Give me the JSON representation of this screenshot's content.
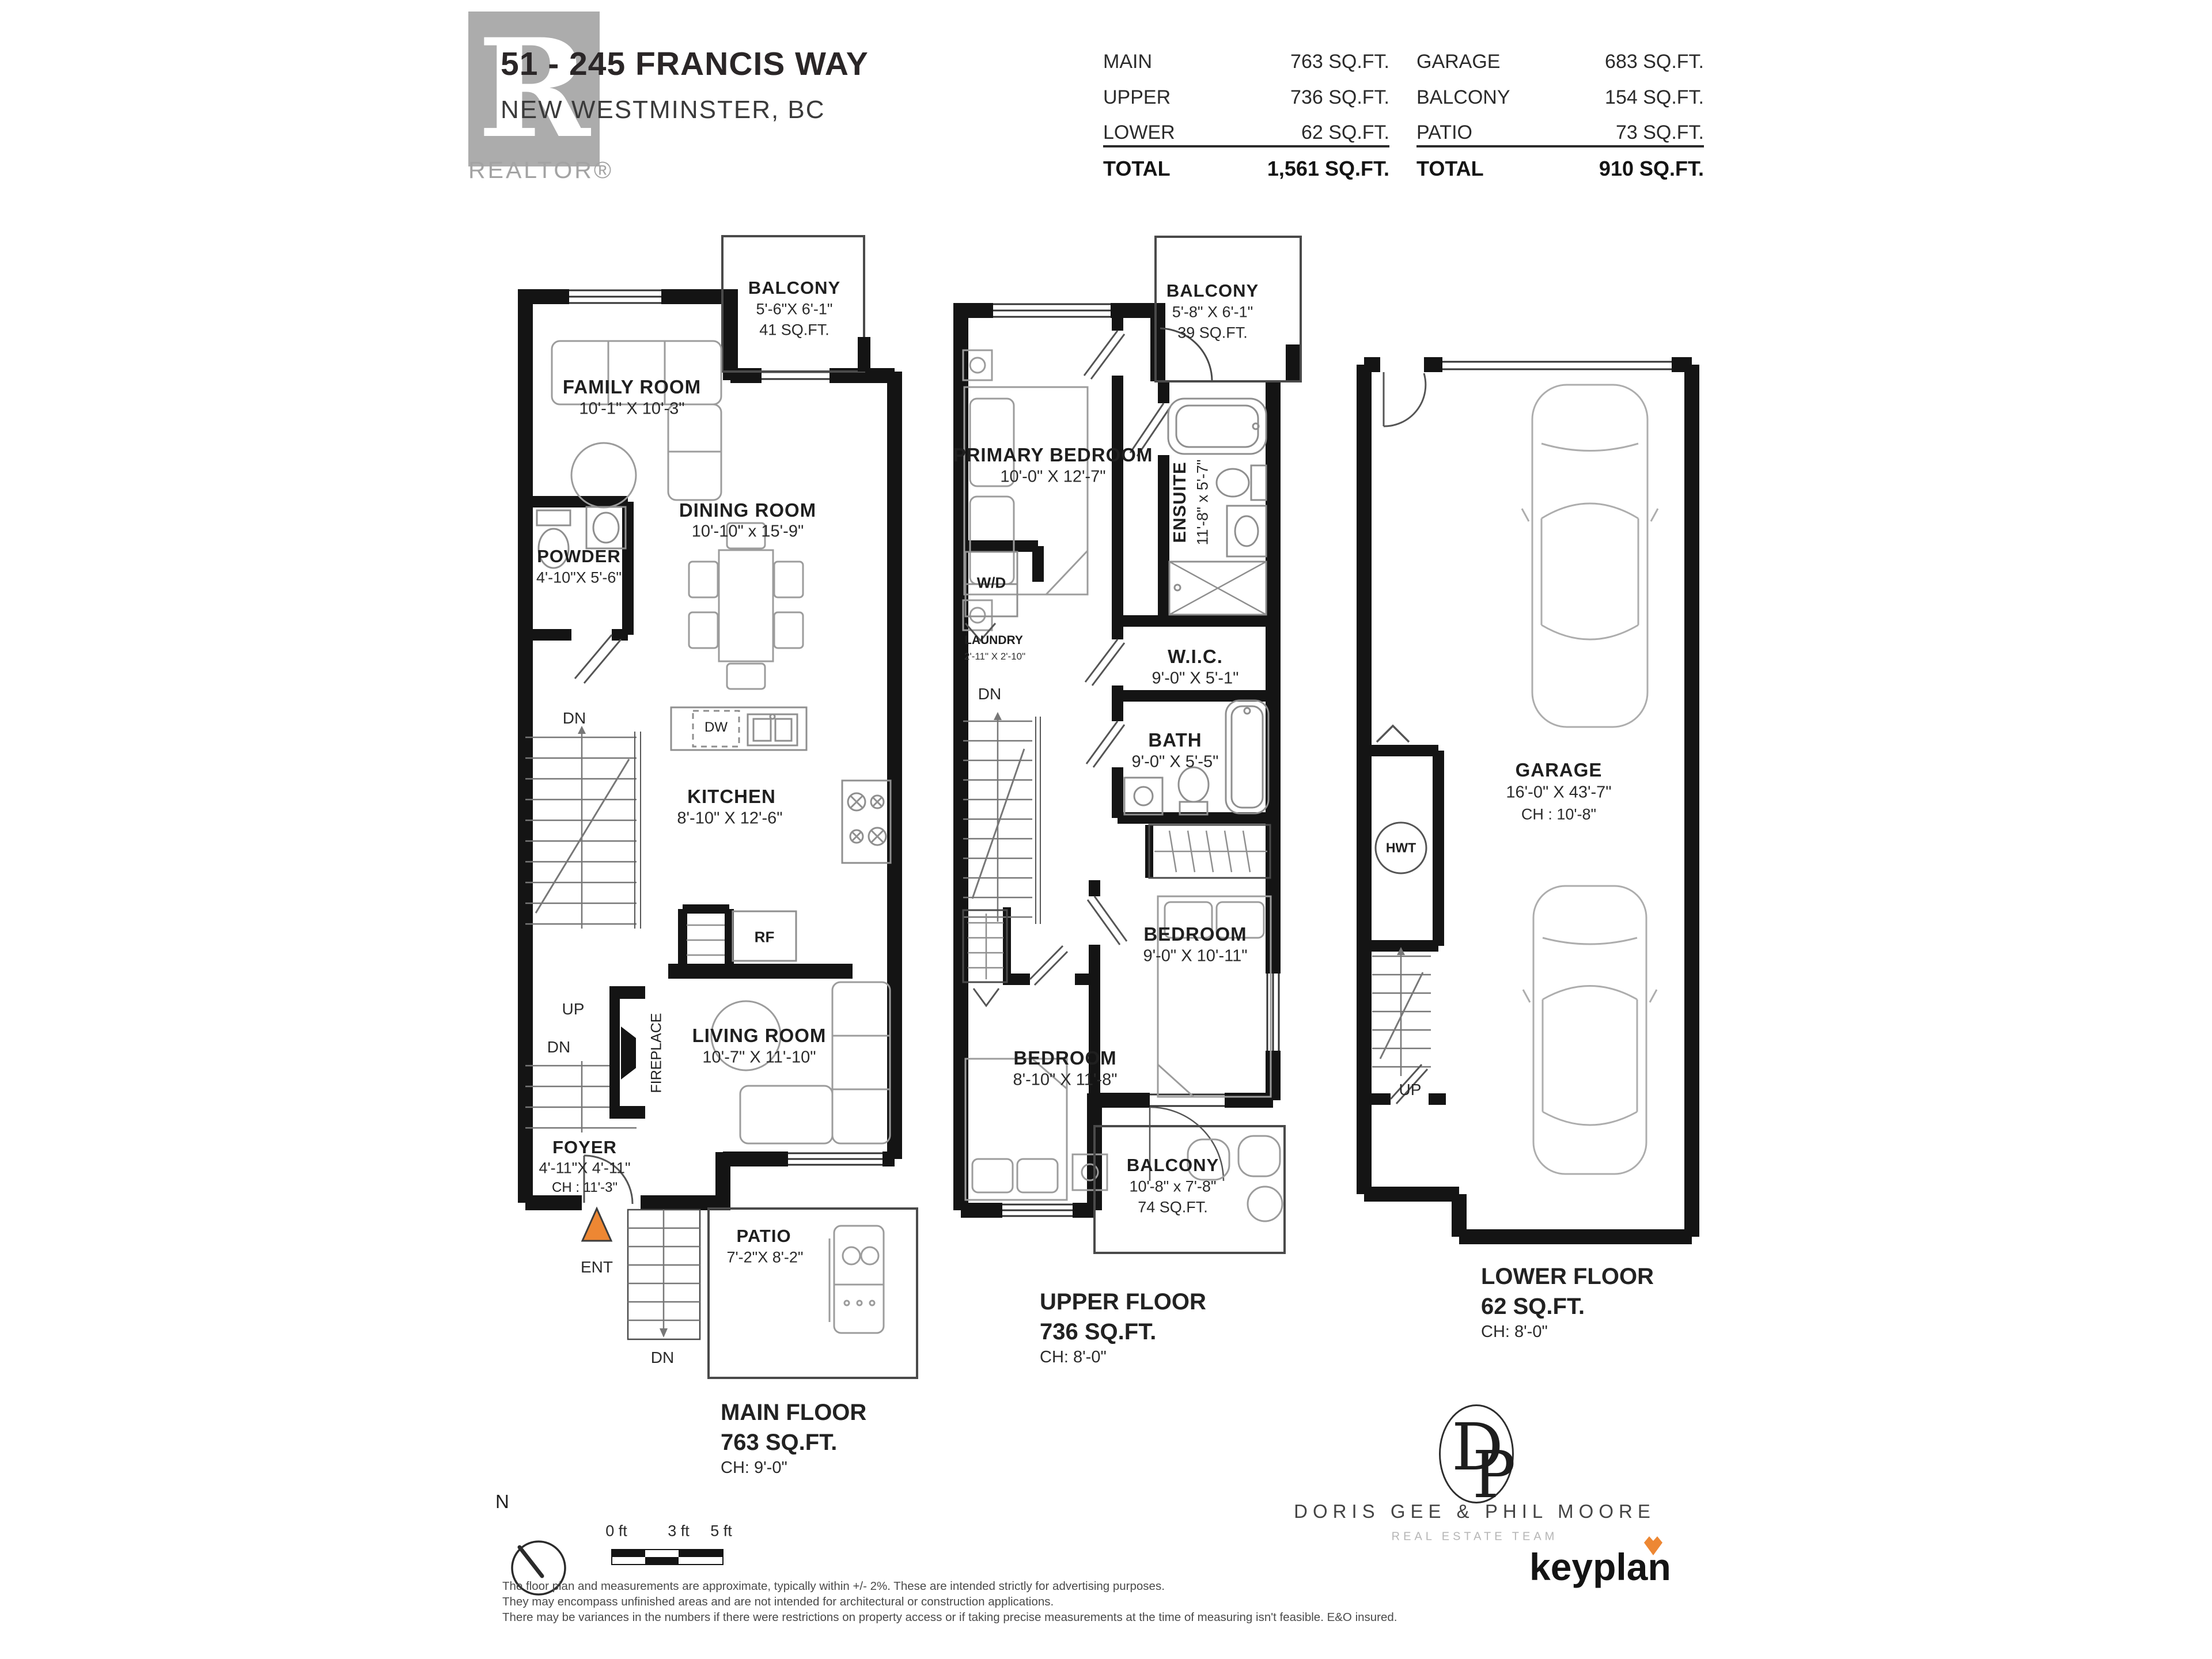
{
  "header": {
    "logo": {
      "letter": "R",
      "label": "REALTOR®"
    },
    "address_line1": "51 - 245 FRANCIS WAY",
    "address_line2": "NEW WESTMINSTER, BC",
    "area_table": {
      "left": {
        "rows": [
          {
            "label": "MAIN",
            "value": "763 SQ.FT."
          },
          {
            "label": "UPPER",
            "value": "736 SQ.FT."
          },
          {
            "label": "LOWER",
            "value": "62 SQ.FT."
          }
        ],
        "total": {
          "label": "TOTAL",
          "value": "1,561 SQ.FT."
        }
      },
      "right": {
        "rows": [
          {
            "label": "GARAGE",
            "value": "683 SQ.FT."
          },
          {
            "label": "BALCONY",
            "value": "154 SQ.FT."
          },
          {
            "label": "PATIO",
            "value": "73 SQ.FT."
          }
        ],
        "total": {
          "label": "TOTAL",
          "value": "910 SQ.FT."
        }
      }
    }
  },
  "main_floor": {
    "balcony": {
      "name": "BALCONY",
      "dim": "5'-6\"X 6'-1\"",
      "area": "41 SQ.FT."
    },
    "family_room": {
      "name": "FAMILY ROOM",
      "dim": "10'-1\"  X  10'-3\""
    },
    "dining_room": {
      "name": "DINING ROOM",
      "dim": "10'-10\"  x  15'-9\""
    },
    "powder": {
      "name": "POWDER",
      "dim": "4'-10\"X 5'-6\""
    },
    "kitchen": {
      "name": "KITCHEN",
      "dim": "8'-10\"  X  12'-6\""
    },
    "living_room": {
      "name": "LIVING ROOM",
      "dim": "10'-7\"  X  11'-10\""
    },
    "foyer": {
      "name": "FOYER",
      "dim": "4'-11\"X 4'-11\"",
      "ch": "CH : 11'-3\""
    },
    "patio": {
      "name": "PATIO",
      "dim": "7'-2\"X 8'-2\""
    },
    "markers": {
      "dn": "DN",
      "up": "UP",
      "dw": "DW",
      "rf": "RF",
      "ent": "ENT",
      "fireplace": "FIREPLACE"
    },
    "floor_label": {
      "line1": "MAIN FLOOR",
      "line2": "763 SQ.FT.",
      "line3": "CH: 9'-0\""
    }
  },
  "upper_floor": {
    "balcony_top": {
      "name": "BALCONY",
      "dim": "5'-8\" X 6'-1\"",
      "area": "39 SQ.FT."
    },
    "primary_bedroom": {
      "name": "PRIMARY BEDROOM",
      "dim": "10'-0\"  X  12'-7\""
    },
    "ensuite": {
      "name": "ENSUITE",
      "dim": "11'-8\" x 5'-7\""
    },
    "laundry": {
      "name": "LAUNDRY",
      "dim": "2'-11\" X 2'-10\""
    },
    "wic": {
      "name": "W.I.C.",
      "dim": "9'-0\"  X  5'-1\""
    },
    "bath": {
      "name": "BATH",
      "dim": "9'-0\" X 5'-5\""
    },
    "bedroom_right": {
      "name": "BEDROOM",
      "dim": "9'-0\"  X  10'-11\""
    },
    "bedroom_left": {
      "name": "BEDROOM",
      "dim": "8'-10\"  X  11'-8\""
    },
    "balcony_bottom": {
      "name": "BALCONY",
      "dim": "10'-8\"  x  7'-8\"",
      "area": "74 SQ.FT."
    },
    "markers": {
      "wd": "W/D",
      "dn": "DN"
    },
    "floor_label": {
      "line1": "UPPER FLOOR",
      "line2": "736 SQ.FT.",
      "line3": "CH: 8'-0\""
    }
  },
  "lower_floor": {
    "garage": {
      "name": "GARAGE",
      "dim": "16'-0\"  X  43'-7\"",
      "ch": "CH : 10'-8\""
    },
    "markers": {
      "hwt": "HWT",
      "up": "UP"
    },
    "floor_label": {
      "line1": "LOWER FLOOR",
      "line2": "62 SQ.FT.",
      "line3": "CH: 8'-0\""
    }
  },
  "footer": {
    "compass_label": "N",
    "scale": {
      "t0": "0 ft",
      "t3": "3 ft",
      "t5": "5 ft"
    },
    "disclaimer": [
      "The floor plan and measurements are approximate, typically within +/- 2%. These are intended strictly for advertising purposes.",
      "They may encompass unfinished areas and are not intended for architectural or construction applications.",
      "There may be variances in the numbers if there were restrictions on property access or if taking precise measurements at the time of measuring isn't feasible. E&O insured."
    ],
    "team_logo": {
      "mono_d": "D",
      "mono_p": "P",
      "name": "DORIS GEE & PHIL MOORE",
      "subtitle": "REAL ESTATE TEAM"
    },
    "brand": {
      "name": "keyplan"
    }
  },
  "colors": {
    "accent_orange": "#ED8733",
    "wall": "#141414",
    "furniture": "#9c9c9c",
    "logo_gray": "#acacac"
  }
}
